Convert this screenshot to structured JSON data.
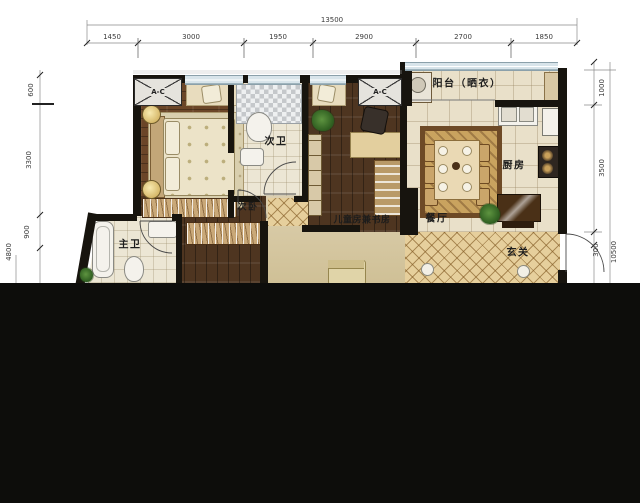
{
  "rooms": {
    "balcony": "阳台（晒衣）",
    "bath2": "次卫",
    "bed2": "次卧",
    "bath1": "主卫",
    "kids": "儿童房兼书房",
    "dining": "餐厅",
    "kitchen": "厨房",
    "entry": "玄关"
  },
  "ac_label": "A-C",
  "dims": {
    "top_total": "13500",
    "top": [
      "1450",
      "3000",
      "1950",
      "2900",
      "2700",
      "1850"
    ],
    "left": [
      "600",
      "3300",
      "900"
    ],
    "left_total": "4800",
    "right": [
      "1000",
      "3500",
      "300"
    ],
    "right_total": "10500"
  }
}
